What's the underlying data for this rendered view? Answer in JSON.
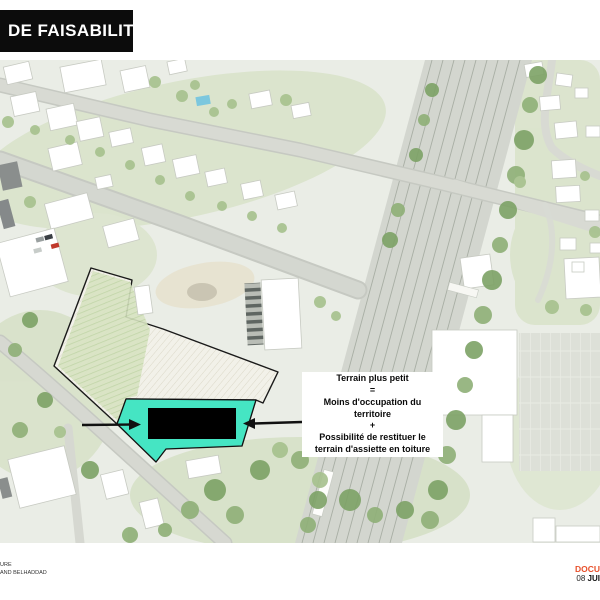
{
  "title": {
    "label": "DE FAISABILITE"
  },
  "annotation": {
    "lines": [
      "Terrain plus petit",
      "=",
      "Moins d'occupation du",
      "territoire",
      "+",
      "Possibilité de restituer le",
      "terrain d'assiette en toiture"
    ]
  },
  "icons": {
    "left_arrow": "arrow-right-icon",
    "right_arrow": "arrow-left-icon"
  },
  "colors": {
    "highlight_teal": "#45E5C3",
    "footprint_black": "#000000",
    "boundary_black": "#1a1a1a",
    "accent_red": "#E8502B",
    "title_bg": "#0C0C0C"
  },
  "footer": {
    "studio_line1": "URE",
    "studio_line2": "AND BELHADDAD",
    "doc_label": "DOCU",
    "date_prefix": "08 ",
    "date_bold": "JUI"
  }
}
